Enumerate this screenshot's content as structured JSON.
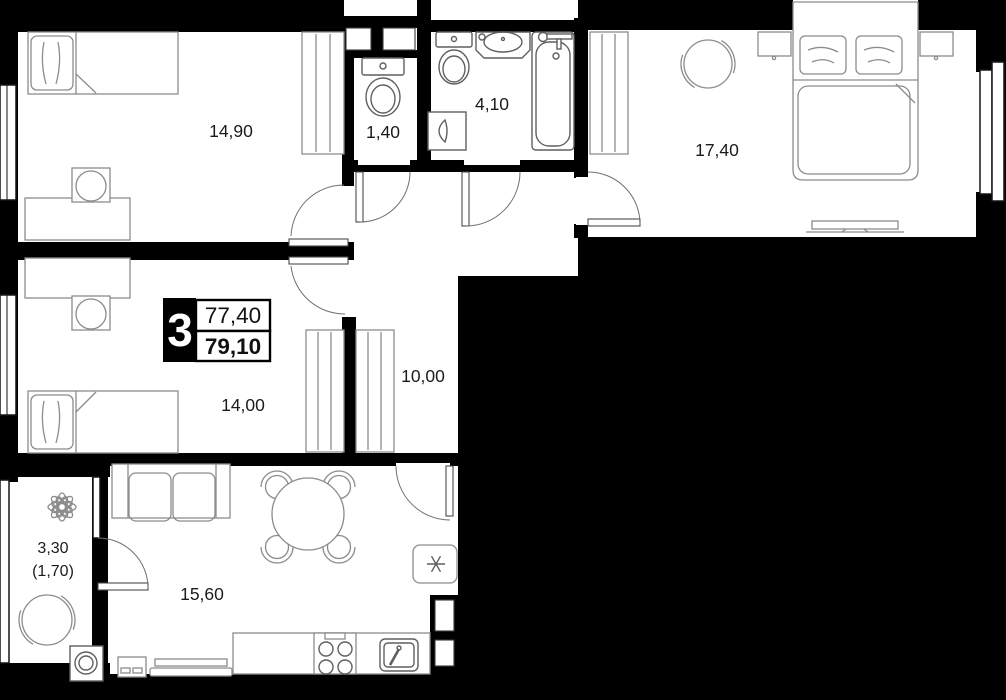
{
  "plan": {
    "badge": {
      "rooms": "3",
      "area_top": "77,40",
      "area_bottom": "79,10"
    },
    "labels": {
      "room_1490": "14,90",
      "wc": "1,40",
      "bathroom": "4,10",
      "bedroom_main": "17,40",
      "room_1400": "14,00",
      "hallway": "10,00",
      "kitchen_living": "15,60",
      "balcony": "3,30",
      "balcony_reduced": "(1,70)"
    },
    "colors": {
      "background": "#000000",
      "floor": "#ffffff",
      "wall": "#000000",
      "furniture": "#8c8c8c",
      "fixture": "#5f5f5f",
      "label": "#1b1b1b"
    }
  }
}
